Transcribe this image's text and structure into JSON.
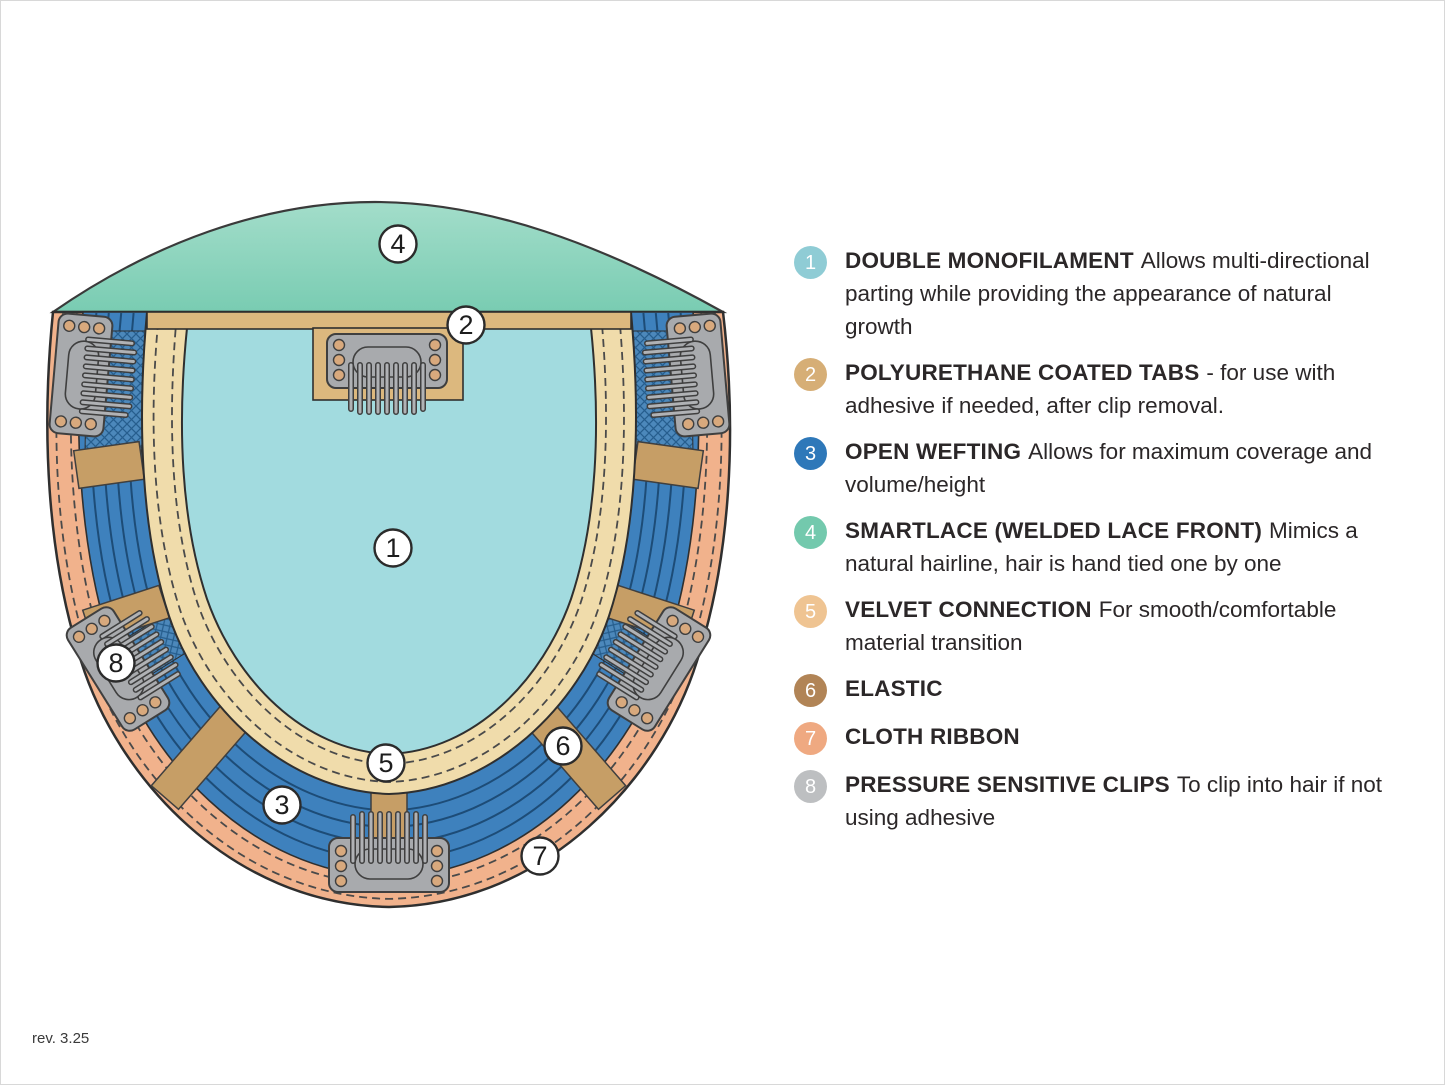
{
  "footer": {
    "revision": "rev. 3.25"
  },
  "legend": {
    "items": [
      {
        "number": "1",
        "color": "#8fccd5",
        "term": "DOUBLE MONOFILAMENT",
        "description": "Allows multi-directional parting while providing the appearance of natural growth"
      },
      {
        "number": "2",
        "color": "#d6ae76",
        "term": "POLYURETHANE COATED TABS",
        "description": "- for use with adhesive if needed, after clip removal."
      },
      {
        "number": "3",
        "color": "#2e78b9",
        "term": "OPEN WEFTING",
        "description": "Allows for maximum coverage and volume/height"
      },
      {
        "number": "4",
        "color": "#73c9ad",
        "term": "SMARTLACE (WELDED LACE FRONT)",
        "description": "Mimics a natural hairline, hair is hand tied one by one"
      },
      {
        "number": "5",
        "color": "#efc492",
        "term": "VELVET CONNECTION",
        "description": "For smooth/comfortable material transition"
      },
      {
        "number": "6",
        "color": "#b18456",
        "term": "ELASTIC",
        "description": ""
      },
      {
        "number": "7",
        "color": "#efa981",
        "term": "CLOTH RIBBON",
        "description": ""
      },
      {
        "number": "8",
        "color": "#bdbfc1",
        "term": "PRESSURE SENSITIVE CLIPS",
        "description": "To clip into hair if not using adhesive"
      }
    ]
  },
  "diagram": {
    "callouts": [
      {
        "number": "1",
        "part": "double-monofilament"
      },
      {
        "number": "2",
        "part": "polyurethane-coated-tabs"
      },
      {
        "number": "3",
        "part": "open-wefting"
      },
      {
        "number": "4",
        "part": "smartlace-welded-lace-front"
      },
      {
        "number": "5",
        "part": "velvet-connection"
      },
      {
        "number": "6",
        "part": "elastic"
      },
      {
        "number": "7",
        "part": "cloth-ribbon"
      },
      {
        "number": "8",
        "part": "pressure-sensitive-clips"
      }
    ],
    "colors": {
      "lace": "#7ccdb6",
      "monofilament": "#a2dbdf",
      "wefting": "#3e81bd",
      "weft_line": "#1d4c77",
      "velvet": "#f0dcab",
      "ribbon": "#f1b28c",
      "tab": "#dcb87e",
      "elastic": "#c69e66",
      "clip": "#a8aaad",
      "outline": "#333333"
    }
  }
}
